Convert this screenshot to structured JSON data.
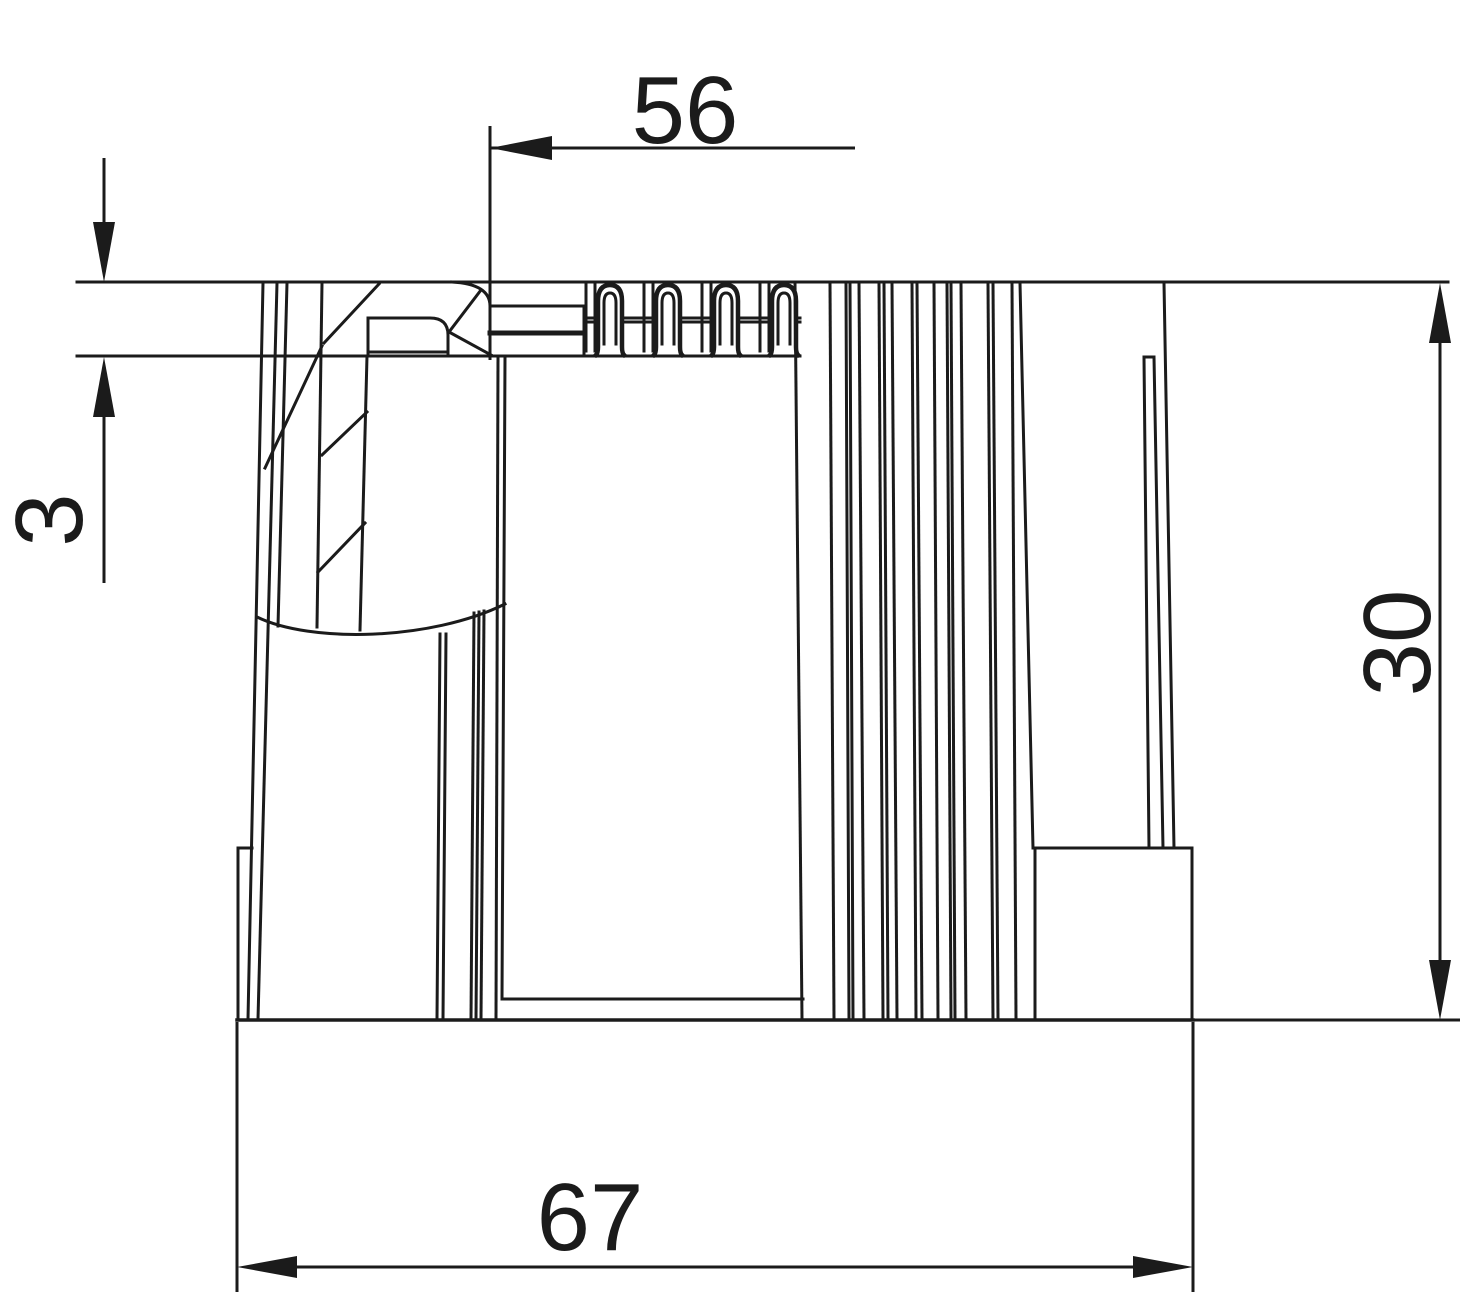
{
  "drawing": {
    "kind": "technical-dimension-drawing",
    "background_color": "#ffffff",
    "line_color": "#1b1b1b",
    "view": "side view of ribbed cylindrical end sleeve with base flange",
    "dimensions": {
      "top": {
        "label": "56",
        "orientation": "horizontal",
        "arrow_style": "single-left"
      },
      "left": {
        "label": "3",
        "orientation": "vertical",
        "arrow_style": "opposing-outside"
      },
      "right": {
        "label": "30",
        "orientation": "vertical",
        "arrow_style": "double-inside"
      },
      "bottom": {
        "label": "67",
        "orientation": "horizontal",
        "arrow_style": "double-inside"
      }
    }
  }
}
